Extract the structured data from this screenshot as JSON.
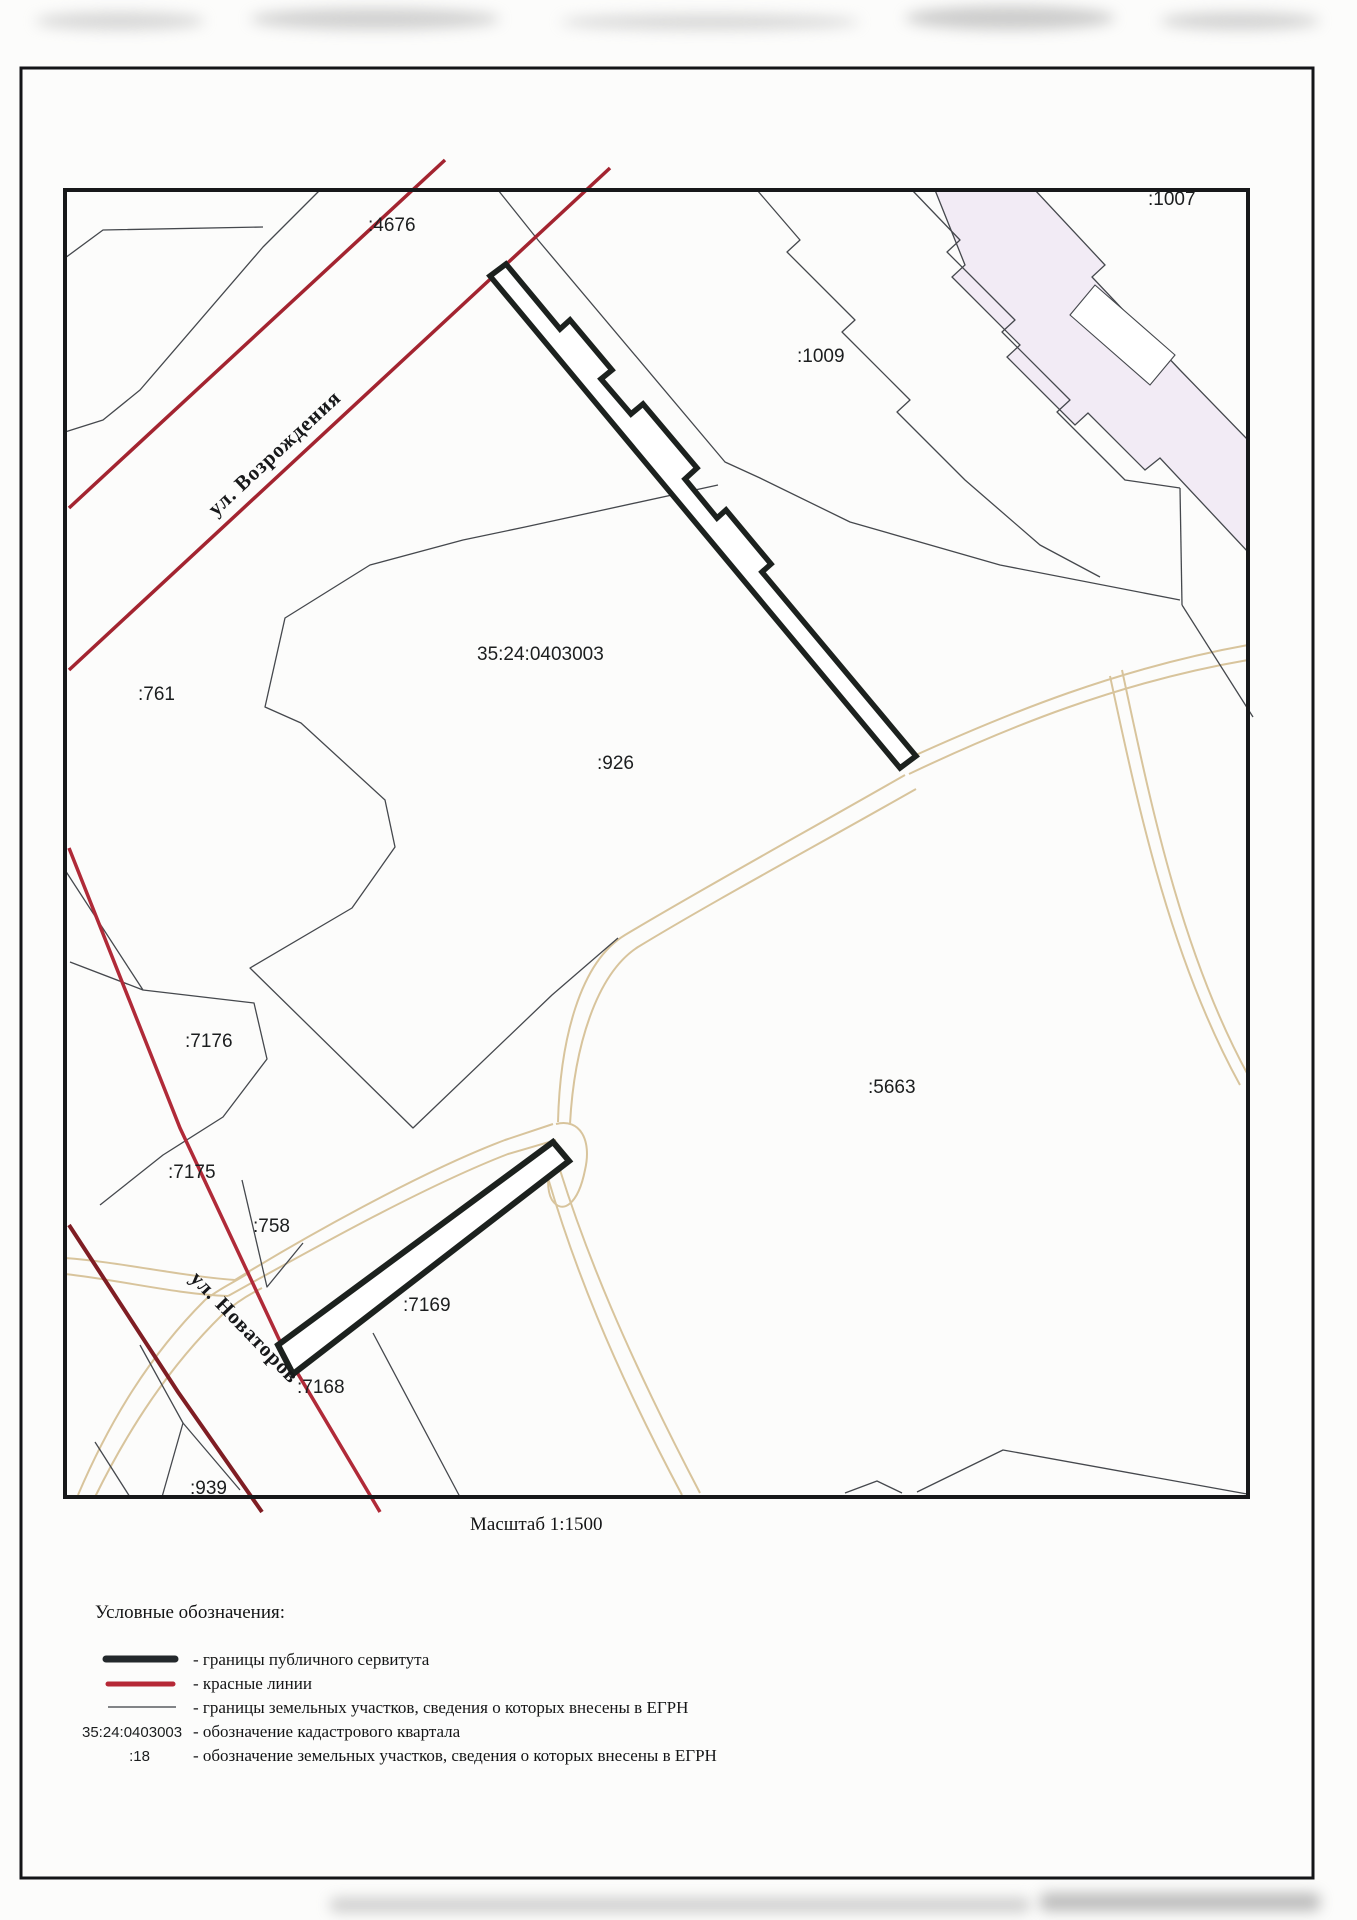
{
  "page": {
    "scale_label": "Масштаб 1:1500"
  },
  "map": {
    "cadastral_quarter": "35:24:0403003",
    "parcels": {
      "p1007": ":1007",
      "p4676": ":4676",
      "p1009": ":1009",
      "p761": ":761",
      "p926": ":926",
      "p7176": ":7176",
      "p7175": ":7175",
      "p758": ":758",
      "p7169": ":7169",
      "p7168": ":7168",
      "p939": ":939",
      "p5663": ":5663"
    },
    "streets": {
      "vozrozhdeniya": "ул. Возрождения",
      "novatorov": "ул. Новаторов"
    }
  },
  "legend": {
    "title": "Условные обозначения:",
    "items": [
      {
        "key": "servitude",
        "label": "- границы публичного сервитута"
      },
      {
        "key": "red_lines",
        "label": "- красные линии"
      },
      {
        "key": "parcel_borders",
        "label": "- границы земельных участков, сведения о которых внесены в ЕГРН"
      },
      {
        "key": "quarter_code",
        "symbol_text": "35:24:0403003",
        "label": "- обозначение кадастрового квартала"
      },
      {
        "key": "parcel_code",
        "symbol_text": ":18",
        "label": "- обозначение земельных участков, сведения о которых внесены в ЕГРН"
      }
    ]
  },
  "colors": {
    "red_line": "#a32430",
    "red_line_dark": "#7f1d23",
    "servitude": "#1c211e",
    "parcel_line": "#45484d",
    "road": "#d8c49c",
    "building_fill": "#f2ebf5",
    "ink": "#1c1e1f"
  }
}
